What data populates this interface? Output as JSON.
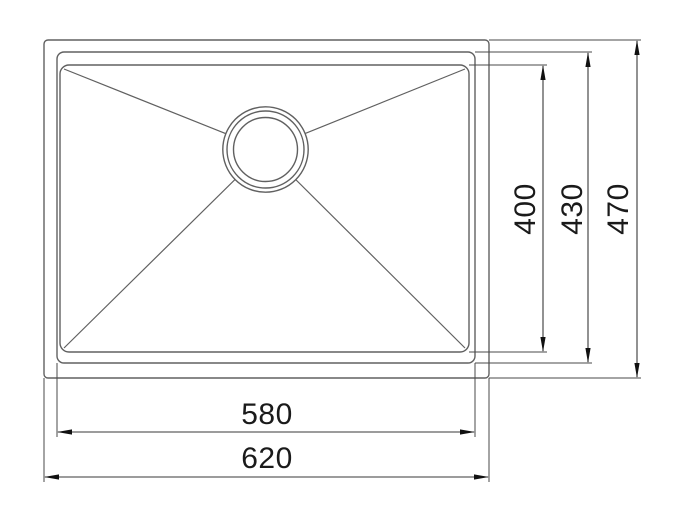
{
  "drawing": {
    "subject": "undermount-sink-top-view-technical-drawing",
    "background_color": "#ffffff",
    "outline_color": "#606060",
    "dimension_line_color": "#3a3a3a",
    "text_color": "#1a1a1a"
  },
  "dimensions": {
    "bowl_width": {
      "value": "580",
      "orientation": "horizontal"
    },
    "overall_width": {
      "value": "620",
      "orientation": "horizontal"
    },
    "bowl_floor_depth": {
      "value": "400",
      "orientation": "vertical"
    },
    "bowl_depth": {
      "value": "430",
      "orientation": "vertical"
    },
    "overall_depth": {
      "value": "470",
      "orientation": "vertical"
    }
  }
}
